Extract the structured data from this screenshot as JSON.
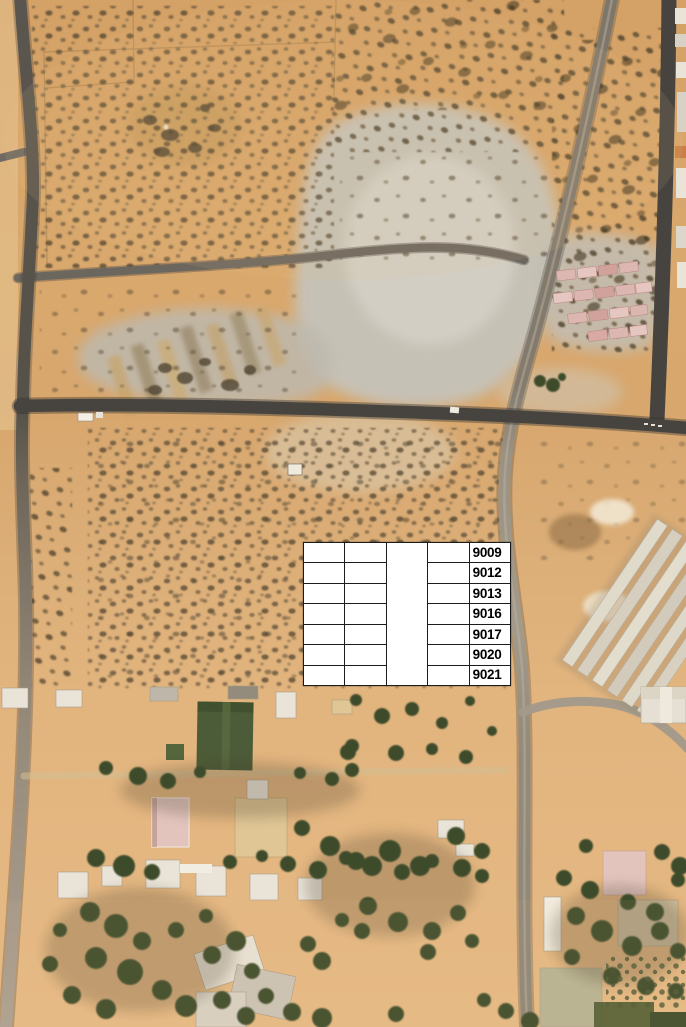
{
  "overlay_table": {
    "columns": 5,
    "rows": 7,
    "plot_ids": [
      "9009",
      "9012",
      "9013",
      "9016",
      "9017",
      "9020",
      "9021"
    ]
  },
  "colors": {
    "sand": "#d7a76c",
    "sand_light": "#e6bb85",
    "sand_dark": "#c2935a",
    "quarry_grey": "#c6c2b8",
    "road_dark": "#474440",
    "road_medium": "#7d766b",
    "road_light": "#a29a8b",
    "tree_green": "#3d4b2c",
    "field_green": "#4d5c38",
    "building_white": "#eae4d8",
    "building_cream": "#e0c695",
    "roof_pink": "#e2c4bd",
    "brick_pink": "#dcb6b0",
    "table_bg": "#ffffff",
    "table_border": "#1c1c1c",
    "table_text": "#000000"
  }
}
